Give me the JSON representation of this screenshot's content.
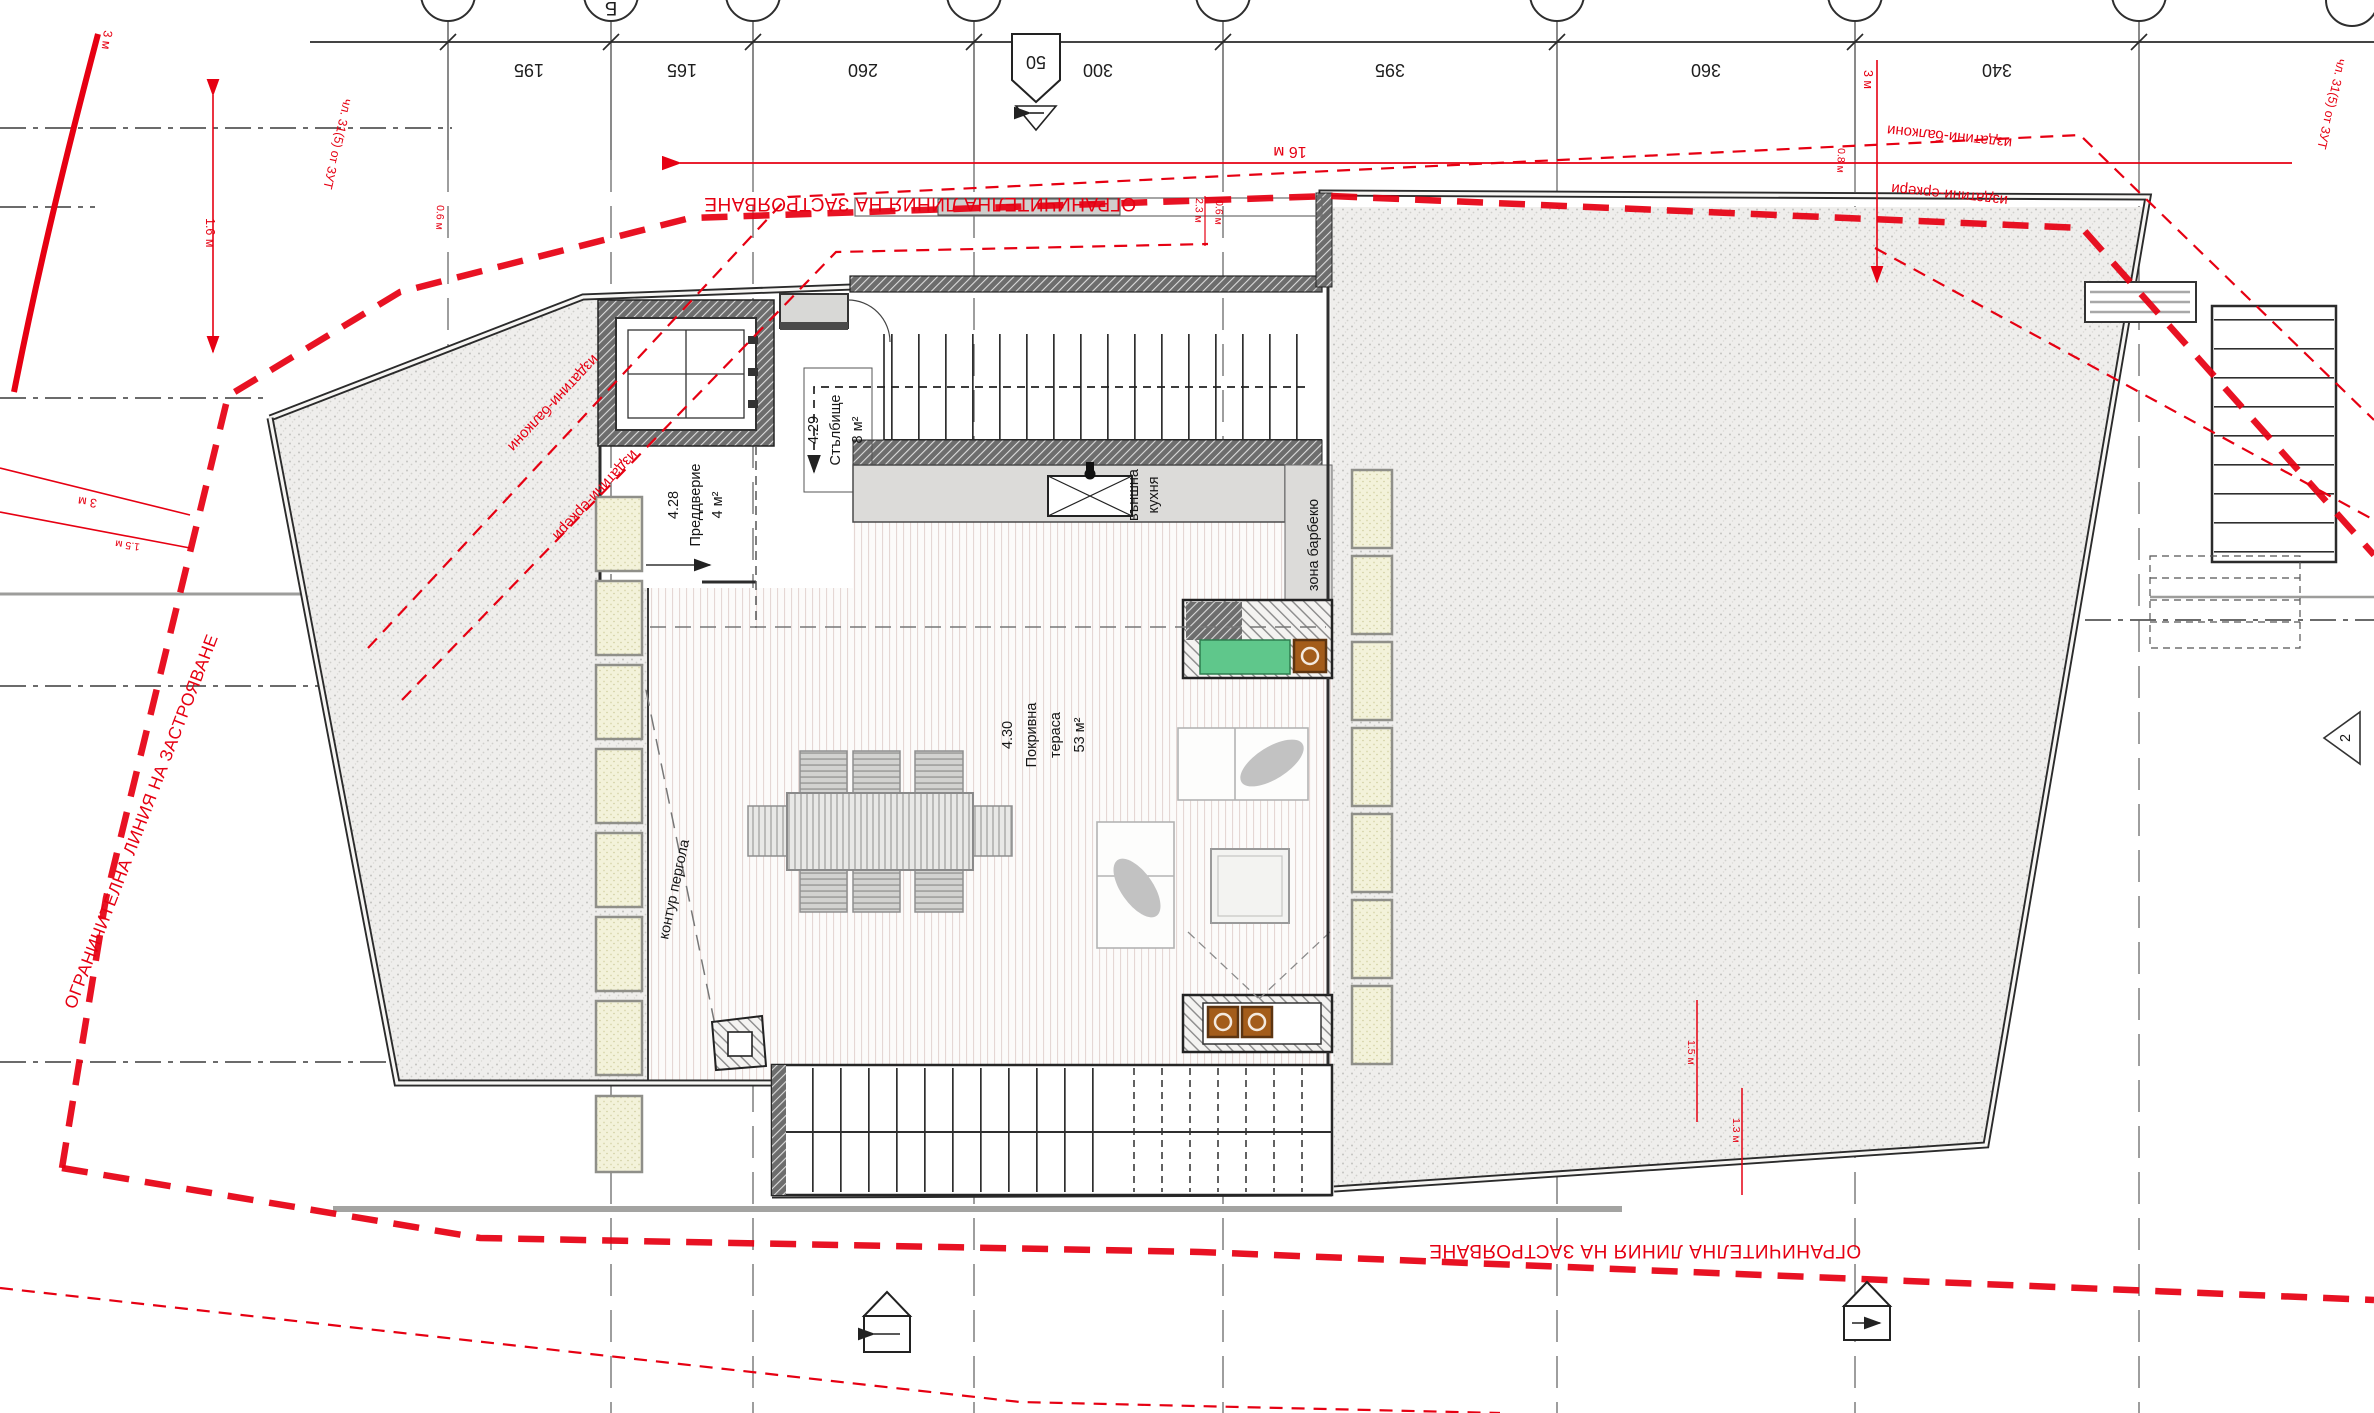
{
  "drawing": {
    "grid": {
      "bubble_label_b": "Б",
      "dims": [
        "195",
        "165",
        "260",
        "300",
        "395",
        "360",
        "340"
      ],
      "section_top": "50",
      "marker_2": "2"
    },
    "red": {
      "setback_top": "ОГРАНИЧИТЕЛНА ЛИНИЯ НА ЗАСТРОЯВАНЕ",
      "setback_bottom": "ОГРАНИЧИТЕЛНА ЛИНИЯ НА ЗАСТРОЯВАНЕ",
      "setback_left": "ОГРАНИЧИТЕЛНА ЛИНИЯ НА ЗАСТРОЯВАНЕ",
      "balconies_left": "издатини-балкони",
      "balconies_right": "издатини-балкони",
      "bays_left": "издатини-еркери",
      "bays_right": "издатини-еркери",
      "law_left": "чл. 31(5) от ЗУТ",
      "law_right": "чл. 31(5) от ЗУТ",
      "dim_16m": "16 м",
      "dim_3m_topleft": "3 м",
      "dim_1_6m": "1.6 м",
      "dim_3m_left": "3 м",
      "dim_1_5m_left": "1.5 м",
      "dim_3m_right": "3 м",
      "dim_2_3m": "2.3 м",
      "dim_0_6m_pair": "0.6 м",
      "dim_0_6m_left": "0.6 м",
      "dim_0_8m": "0.8 м",
      "dim_1_5m_bottom": "1.5 м",
      "dim_1_3m_bottom": "1.3 м"
    },
    "rooms": {
      "r428": {
        "num": "4.28",
        "name": "Преддверие",
        "area": "4 м²"
      },
      "r429": {
        "num": "4.29",
        "name": "Стълбище",
        "area": "8 м²"
      },
      "r430": {
        "num": "4.30",
        "name1": "Покривна",
        "name2": "тераса",
        "area": "53 м²"
      }
    },
    "labels": {
      "kitchen1": "външна",
      "kitchen2": "кухня",
      "bbq": "зона барбекю",
      "pergola": "контур пергола"
    },
    "colors": {
      "red": "#e60012",
      "line": "#262626",
      "green": "#5fc78b",
      "brown": "#a35c1a"
    }
  }
}
